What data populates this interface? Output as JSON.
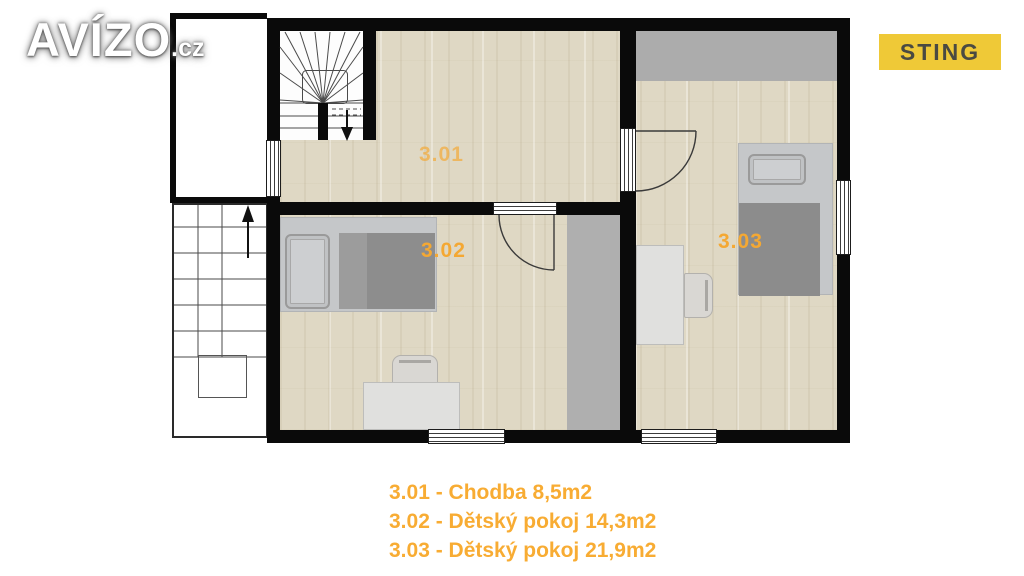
{
  "branding": {
    "logo_text": "AVÍZO",
    "logo_suffix": ".cz",
    "agency_badge": "STING"
  },
  "floorplan": {
    "title": "Upper floor plan",
    "rooms": [
      {
        "label": "3.01",
        "name": "Chodba",
        "area": "8,5m2"
      },
      {
        "label": "3.02",
        "name": "Dětský pokoj",
        "area": "14,3m2"
      },
      {
        "label": "3.03",
        "name": "Dětský pokoj",
        "area": "21,9m2"
      }
    ]
  },
  "legend": {
    "lines": [
      "3.01 - Chodba 8,5m2",
      "3.02 - Dětský pokoj 14,3m2",
      "3.03 - Dětský pokoj 21,9m2"
    ]
  },
  "colors": {
    "label_orange": "#F4A833",
    "legend_orange": "#F8AC33",
    "badge_background": "#EFC937",
    "badge_text": "#4A4A42",
    "wall_black": "#0A0A0A",
    "floor_wood": "#DFD8C4",
    "low_headroom_gray": "#ACACAC",
    "furniture_gray": "#8F8F8F"
  }
}
